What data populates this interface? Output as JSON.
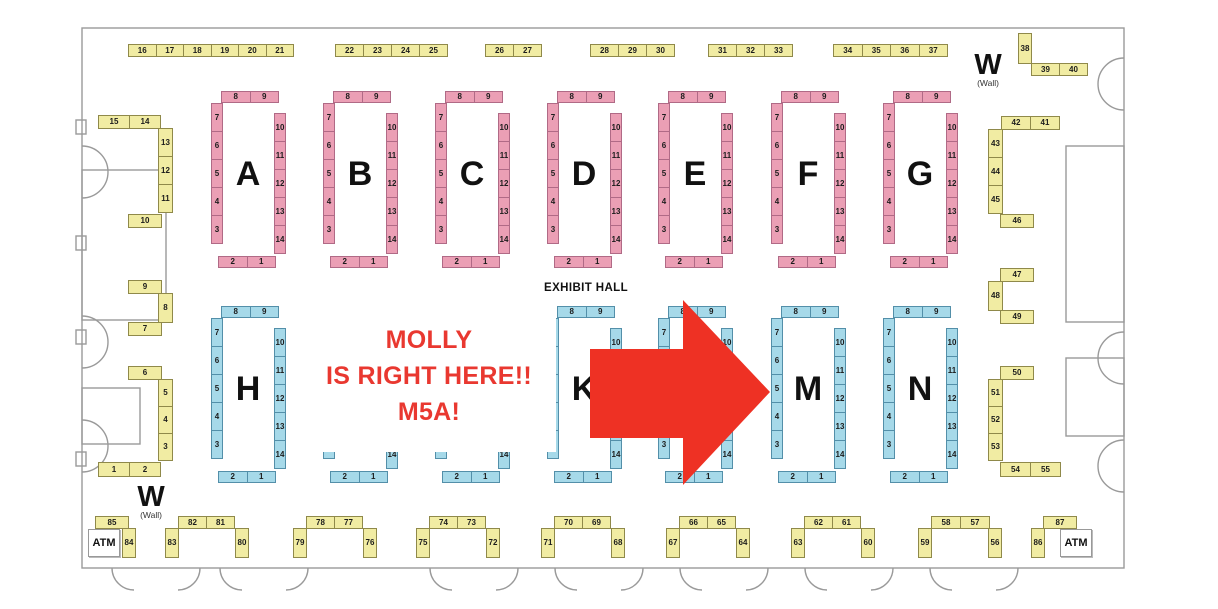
{
  "map": {
    "exhibit_hall_label": "EXHIBIT HALL",
    "wall_label_top_right": {
      "main": "W",
      "sub": "(Wall)"
    },
    "wall_label_bottom_left": {
      "main": "W",
      "sub": "(Wall)"
    },
    "atm_left_label": "ATM",
    "atm_right_label": "ATM"
  },
  "annotation": {
    "line1": "MOLLY",
    "line2": "IS RIGHT HERE!!",
    "line3": "M5A!",
    "text_color": "#e93830",
    "arrow_color": "#ee3124",
    "target_booth": "M5A"
  },
  "colors": {
    "booth_yellow": "#f1eca3",
    "booth_pink": "#eb9fb5",
    "booth_blue": "#a6d9e9",
    "wall_gray": "#9a9a9a"
  },
  "islands": {
    "template": {
      "top": [
        "8",
        "9"
      ],
      "left": [
        "7",
        "6",
        "5",
        "4",
        "3"
      ],
      "right": [
        "10",
        "11",
        "12",
        "13",
        "14"
      ],
      "bottom": [
        "2",
        "1"
      ]
    },
    "row_pink": {
      "y": 91,
      "color": "c-pink",
      "items": [
        {
          "letter": "A",
          "x": 211
        },
        {
          "letter": "B",
          "x": 323
        },
        {
          "letter": "C",
          "x": 435
        },
        {
          "letter": "D",
          "x": 547
        },
        {
          "letter": "E",
          "x": 658
        },
        {
          "letter": "F",
          "x": 771
        },
        {
          "letter": "G",
          "x": 883
        }
      ]
    },
    "row_blue": {
      "y": 306,
      "color": "c-blue",
      "items": [
        {
          "letter": "H",
          "x": 211
        },
        {
          "letter": "",
          "x": 323
        },
        {
          "letter": "",
          "x": 435
        },
        {
          "letter": "K",
          "x": 547
        },
        {
          "letter": "",
          "x": 658
        },
        {
          "letter": "M",
          "x": 771
        },
        {
          "letter": "N",
          "x": 883
        }
      ]
    }
  },
  "strips": [
    {
      "name": "booths-16-21",
      "x": 128,
      "y": 44,
      "dir": "h",
      "cw": 28.5,
      "ch": 13,
      "cells": [
        "16",
        "17",
        "18",
        "19",
        "20",
        "21"
      ]
    },
    {
      "name": "booths-22-25",
      "x": 335,
      "y": 44,
      "dir": "h",
      "cw": 29,
      "ch": 13,
      "cells": [
        "22",
        "23",
        "24",
        "25"
      ]
    },
    {
      "name": "booths-26-27",
      "x": 485,
      "y": 44,
      "dir": "h",
      "cw": 29,
      "ch": 13,
      "cells": [
        "26",
        "27"
      ]
    },
    {
      "name": "booths-28-30",
      "x": 590,
      "y": 44,
      "dir": "h",
      "cw": 29,
      "ch": 13,
      "cells": [
        "28",
        "29",
        "30"
      ]
    },
    {
      "name": "booths-31-33",
      "x": 708,
      "y": 44,
      "dir": "h",
      "cw": 29,
      "ch": 13,
      "cells": [
        "31",
        "32",
        "33"
      ]
    },
    {
      "name": "booths-34-37",
      "x": 833,
      "y": 44,
      "dir": "h",
      "cw": 29.5,
      "ch": 13,
      "cells": [
        "34",
        "35",
        "36",
        "37"
      ]
    },
    {
      "name": "booth-38",
      "x": 1018,
      "y": 33,
      "dir": "v",
      "cw": 14,
      "ch": 31,
      "cells": [
        "38"
      ]
    },
    {
      "name": "booths-39-40",
      "x": 1031,
      "y": 63,
      "dir": "h",
      "cw": 29,
      "ch": 13,
      "cells": [
        "39",
        "40"
      ]
    },
    {
      "name": "booths-15-14",
      "x": 98,
      "y": 115,
      "dir": "h",
      "cw": 32,
      "ch": 14,
      "cells": [
        "15",
        "14"
      ]
    },
    {
      "name": "booths-13-11",
      "x": 158,
      "y": 128,
      "dir": "v",
      "cw": 15,
      "ch": 29,
      "cells": [
        "13",
        "12",
        "11"
      ]
    },
    {
      "name": "booth-10",
      "x": 128,
      "y": 214,
      "dir": "h",
      "cw": 34,
      "ch": 14,
      "cells": [
        "10"
      ]
    },
    {
      "name": "booth-9",
      "x": 128,
      "y": 280,
      "dir": "h",
      "cw": 34,
      "ch": 14,
      "cells": [
        "9"
      ]
    },
    {
      "name": "booth-8",
      "x": 158,
      "y": 293,
      "dir": "v",
      "cw": 15,
      "ch": 30,
      "cells": [
        "8"
      ]
    },
    {
      "name": "booth-7",
      "x": 128,
      "y": 322,
      "dir": "h",
      "cw": 34,
      "ch": 14,
      "cells": [
        "7"
      ]
    },
    {
      "name": "booth-6",
      "x": 128,
      "y": 366,
      "dir": "h",
      "cw": 34,
      "ch": 14,
      "cells": [
        "6"
      ]
    },
    {
      "name": "booths-5-3",
      "x": 158,
      "y": 379,
      "dir": "v",
      "cw": 15,
      "ch": 28,
      "cells": [
        "5",
        "4",
        "3"
      ]
    },
    {
      "name": "booths-1-2",
      "x": 98,
      "y": 462,
      "dir": "h",
      "cw": 32,
      "ch": 15,
      "cells": [
        "1",
        "2"
      ]
    },
    {
      "name": "booths-42-41",
      "x": 1001,
      "y": 116,
      "dir": "h",
      "cw": 30,
      "ch": 14,
      "cells": [
        "42",
        "41"
      ]
    },
    {
      "name": "booths-43-45",
      "x": 988,
      "y": 129,
      "dir": "v",
      "cw": 15,
      "ch": 29,
      "cells": [
        "43",
        "44",
        "45"
      ]
    },
    {
      "name": "booth-46",
      "x": 1000,
      "y": 214,
      "dir": "h",
      "cw": 34,
      "ch": 14,
      "cells": [
        "46"
      ]
    },
    {
      "name": "booth-47",
      "x": 1000,
      "y": 268,
      "dir": "h",
      "cw": 34,
      "ch": 14,
      "cells": [
        "47"
      ]
    },
    {
      "name": "booth-48",
      "x": 988,
      "y": 281,
      "dir": "v",
      "cw": 15,
      "ch": 30,
      "cells": [
        "48"
      ]
    },
    {
      "name": "booth-49",
      "x": 1000,
      "y": 310,
      "dir": "h",
      "cw": 34,
      "ch": 14,
      "cells": [
        "49"
      ]
    },
    {
      "name": "booth-50",
      "x": 1000,
      "y": 366,
      "dir": "h",
      "cw": 34,
      "ch": 14,
      "cells": [
        "50"
      ]
    },
    {
      "name": "booths-51-53",
      "x": 988,
      "y": 379,
      "dir": "v",
      "cw": 15,
      "ch": 28,
      "cells": [
        "51",
        "52",
        "53"
      ]
    },
    {
      "name": "booths-54-55",
      "x": 1000,
      "y": 462,
      "dir": "h",
      "cw": 31,
      "ch": 15,
      "cells": [
        "54",
        "55"
      ]
    },
    {
      "name": "booth-85",
      "x": 95,
      "y": 516,
      "dir": "h",
      "cw": 34,
      "ch": 13,
      "cells": [
        "85"
      ]
    },
    {
      "name": "booth-84",
      "x": 122,
      "y": 528,
      "dir": "v",
      "cw": 14,
      "ch": 30,
      "cells": [
        "84"
      ]
    },
    {
      "name": "booths-82-81",
      "x": 178,
      "y": 516,
      "dir": "h",
      "cw": 29,
      "ch": 13,
      "cells": [
        "82",
        "81"
      ]
    },
    {
      "name": "booth-83",
      "x": 165,
      "y": 528,
      "dir": "v",
      "cw": 14,
      "ch": 30,
      "cells": [
        "83"
      ]
    },
    {
      "name": "booth-80",
      "x": 235,
      "y": 528,
      "dir": "v",
      "cw": 14,
      "ch": 30,
      "cells": [
        "80"
      ]
    },
    {
      "name": "booths-78-77",
      "x": 306,
      "y": 516,
      "dir": "h",
      "cw": 29,
      "ch": 13,
      "cells": [
        "78",
        "77"
      ]
    },
    {
      "name": "booth-79",
      "x": 293,
      "y": 528,
      "dir": "v",
      "cw": 14,
      "ch": 30,
      "cells": [
        "79"
      ]
    },
    {
      "name": "booth-76",
      "x": 363,
      "y": 528,
      "dir": "v",
      "cw": 14,
      "ch": 30,
      "cells": [
        "76"
      ]
    },
    {
      "name": "booths-74-73",
      "x": 429,
      "y": 516,
      "dir": "h",
      "cw": 29,
      "ch": 13,
      "cells": [
        "74",
        "73"
      ]
    },
    {
      "name": "booth-75",
      "x": 416,
      "y": 528,
      "dir": "v",
      "cw": 14,
      "ch": 30,
      "cells": [
        "75"
      ]
    },
    {
      "name": "booth-72",
      "x": 486,
      "y": 528,
      "dir": "v",
      "cw": 14,
      "ch": 30,
      "cells": [
        "72"
      ]
    },
    {
      "name": "booths-70-69",
      "x": 554,
      "y": 516,
      "dir": "h",
      "cw": 29,
      "ch": 13,
      "cells": [
        "70",
        "69"
      ]
    },
    {
      "name": "booth-71",
      "x": 541,
      "y": 528,
      "dir": "v",
      "cw": 14,
      "ch": 30,
      "cells": [
        "71"
      ]
    },
    {
      "name": "booth-68",
      "x": 611,
      "y": 528,
      "dir": "v",
      "cw": 14,
      "ch": 30,
      "cells": [
        "68"
      ]
    },
    {
      "name": "booths-66-65",
      "x": 679,
      "y": 516,
      "dir": "h",
      "cw": 29,
      "ch": 13,
      "cells": [
        "66",
        "65"
      ]
    },
    {
      "name": "booth-67",
      "x": 666,
      "y": 528,
      "dir": "v",
      "cw": 14,
      "ch": 30,
      "cells": [
        "67"
      ]
    },
    {
      "name": "booth-64",
      "x": 736,
      "y": 528,
      "dir": "v",
      "cw": 14,
      "ch": 30,
      "cells": [
        "64"
      ]
    },
    {
      "name": "booths-62-61",
      "x": 804,
      "y": 516,
      "dir": "h",
      "cw": 29,
      "ch": 13,
      "cells": [
        "62",
        "61"
      ]
    },
    {
      "name": "booth-63",
      "x": 791,
      "y": 528,
      "dir": "v",
      "cw": 14,
      "ch": 30,
      "cells": [
        "63"
      ]
    },
    {
      "name": "booth-60",
      "x": 861,
      "y": 528,
      "dir": "v",
      "cw": 14,
      "ch": 30,
      "cells": [
        "60"
      ]
    },
    {
      "name": "booths-58-57",
      "x": 931,
      "y": 516,
      "dir": "h",
      "cw": 30,
      "ch": 13,
      "cells": [
        "58",
        "57"
      ]
    },
    {
      "name": "booth-59",
      "x": 918,
      "y": 528,
      "dir": "v",
      "cw": 14,
      "ch": 30,
      "cells": [
        "59"
      ]
    },
    {
      "name": "booth-56",
      "x": 988,
      "y": 528,
      "dir": "v",
      "cw": 14,
      "ch": 30,
      "cells": [
        "56"
      ]
    },
    {
      "name": "booth-87",
      "x": 1043,
      "y": 516,
      "dir": "h",
      "cw": 34,
      "ch": 13,
      "cells": [
        "87"
      ]
    },
    {
      "name": "booth-86",
      "x": 1031,
      "y": 528,
      "dir": "v",
      "cw": 14,
      "ch": 30,
      "cells": [
        "86"
      ]
    }
  ]
}
